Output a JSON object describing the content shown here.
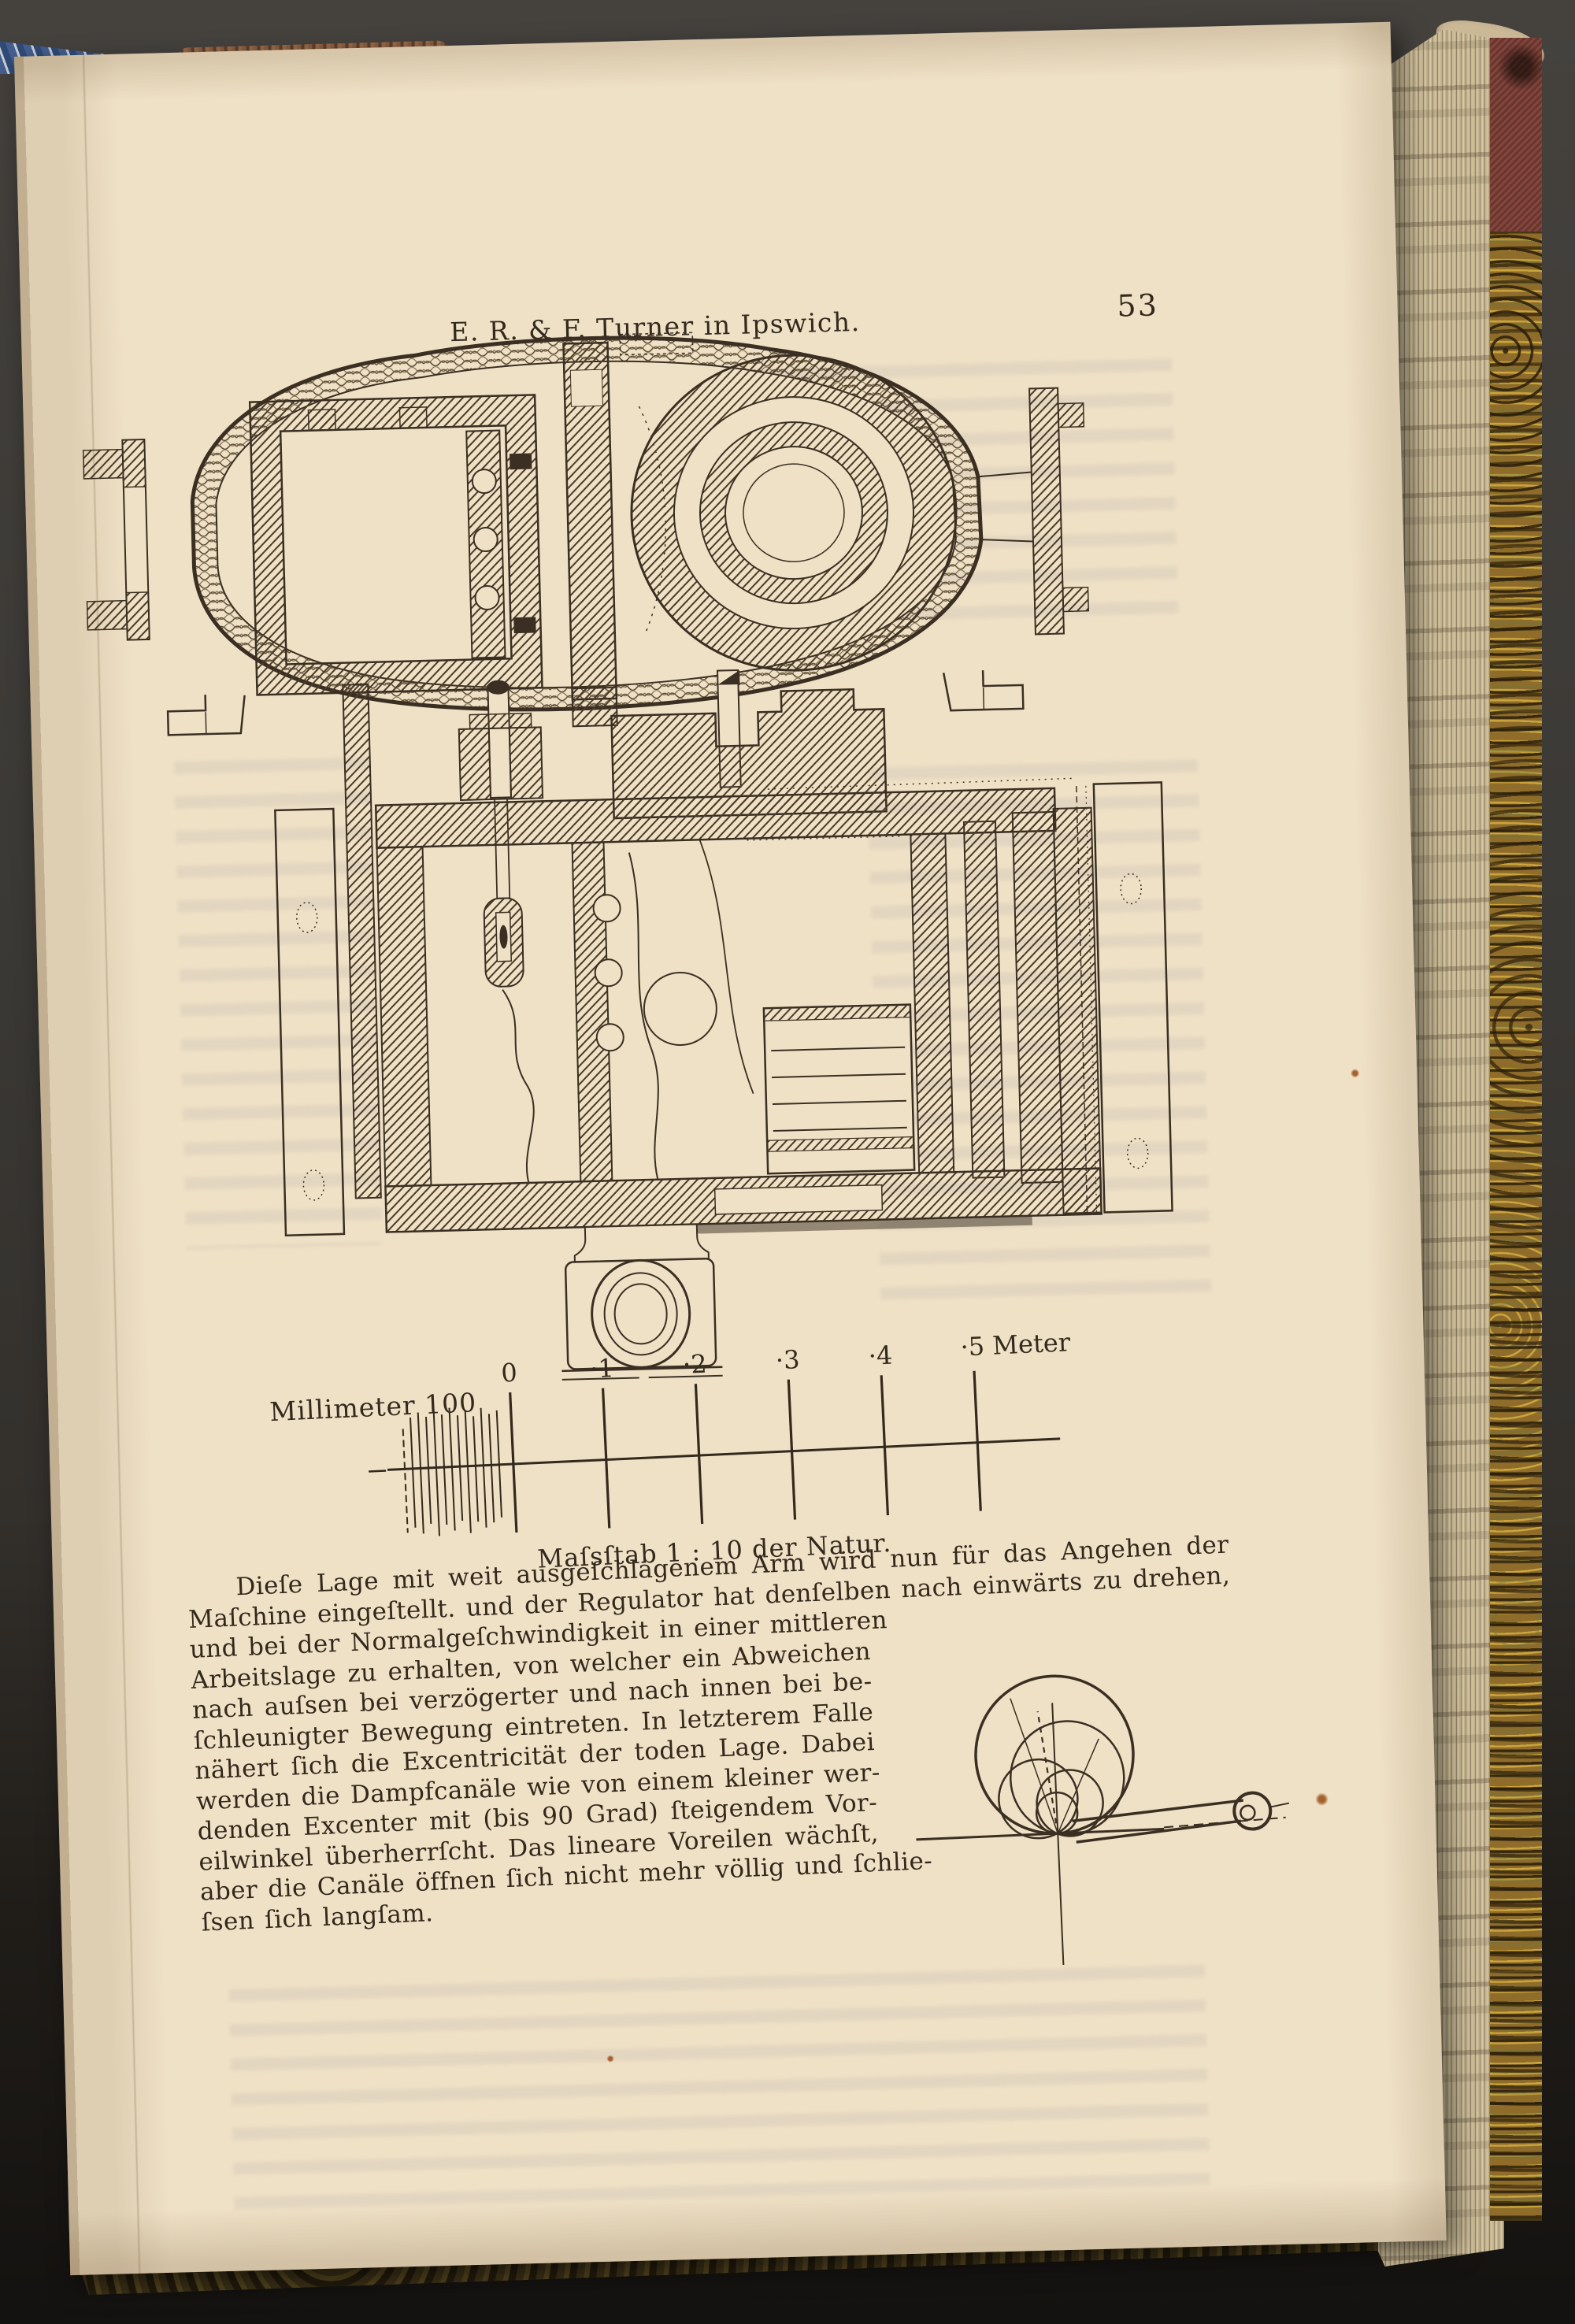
{
  "page": {
    "header": {
      "title": "E. R. & F. Turner in Ipswich.",
      "page_number": "53"
    },
    "scale_bar": {
      "left_label": "Millimeter 100",
      "tick_labels": [
        "0",
        "·1",
        "·2",
        "·3",
        "·4"
      ],
      "end_label": "·5 Meter",
      "caption": "Maſsſtab 1 : 10 der Natur."
    },
    "paragraph": {
      "lines": [
        "Dieſe Lage mit weit ausgeſchlagenem Arm wird nun für das Angehen der",
        "Maſchine eingeſtellt. und der Regulator hat denſelben nach einwärts zu drehen,",
        "und bei der Normalgeſchwindigkeit in einer mittleren",
        "Arbeitslage zu erhalten, von welcher ein Abweichen",
        "nach auſsen bei verzögerter und nach innen bei be-",
        "ſchleunigter Bewegung eintreten. In letzterem Falle",
        "nähert ſich die Excentricität der toden Lage. Dabei",
        "werden die Dampfcanäle wie von einem kleiner wer-",
        "denden Excenter mit (bis 90 Grad) ſteigendem Vor-",
        "eilwinkel überherrſcht. Das lineare Voreilen wächſt,",
        "aber die Canäle öffnen ſich nicht mehr völlig und ſchlie-",
        "ſsen ſich langſam."
      ]
    },
    "colors": {
      "paper": "#efe1c6",
      "ink": "#3a2f22",
      "background": "#3b3935",
      "cover_red": "#84453c",
      "cover_marble": "#8f6c2a",
      "fore_edge": "#c9ba95",
      "headband_blue": "#44639a"
    }
  }
}
